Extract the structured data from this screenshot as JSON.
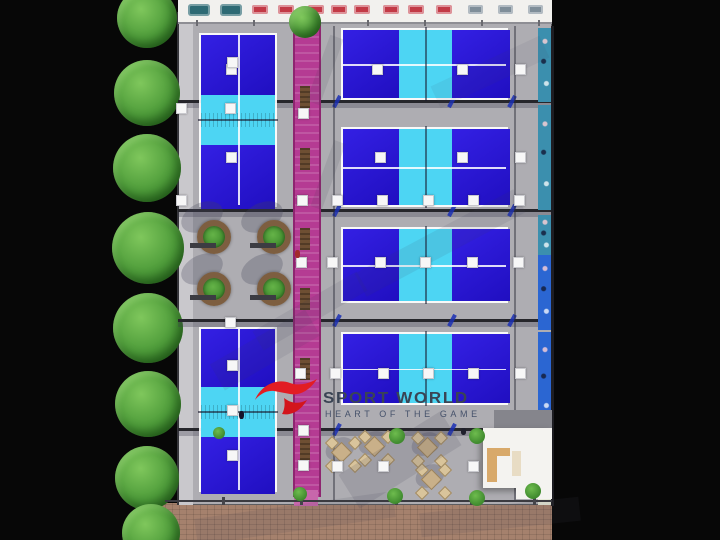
{
  "meta": {
    "description": "Top-down 3D architectural rendering of an indoor padel sports facility",
    "brand": {
      "title": "SPORT WORLD",
      "tagline": "HEART OF THE GAME"
    }
  },
  "colors": {
    "background": "#070707",
    "floor": "#aeadb2",
    "canopy": "#f2f1ee",
    "wall_left": "#c9c8cc",
    "court_blue": "#2712e2",
    "court_blue_dark": "#1d0abd",
    "court_cyan": "#4dd5f3",
    "court_line": "#ffffff",
    "walkway": "#b53b93",
    "walkway_edge": "#8e2570",
    "walkway_ramp": "#c767ab",
    "beam": "#26262b",
    "brace_blue": "#1b2fb4",
    "planter_ring": "#7d5e40",
    "bench_wood": "#6e4f33",
    "pavement": "#a5816d",
    "mural_teal": "#3b8fae",
    "mural_blue": "#2b66d2",
    "mural_pale": "#e6ead9",
    "building_white": "#f4f3f0",
    "roof_gray": "#85858c",
    "table_red": "#c23a46",
    "sofa_teal": "#2e6a74",
    "table_gray": "#7f8e99",
    "wood_counter": "#d8a96a",
    "light_white": "#f7f7f7",
    "logo_red": "#e21d23",
    "logo_text": "#3a4454"
  },
  "scene": {
    "building": {
      "x": 178,
      "y": 0,
      "w": 374,
      "h": 505
    },
    "pavement": {
      "x": 158,
      "y": 503,
      "w": 394,
      "h": 37
    },
    "canopy": {
      "x": 178,
      "y": 0,
      "w": 374,
      "h": 22
    },
    "left_wall": {
      "x": 177,
      "y": 12,
      "w": 14,
      "h": 493
    },
    "walkway": {
      "x": 293,
      "y": 20,
      "w": 24,
      "h": 477
    },
    "beams_y": [
      100,
      209,
      319,
      428
    ],
    "vertical_lines_x": [
      333,
      514
    ],
    "courts": [
      {
        "id": "court-left-top",
        "x": 199,
        "y": 33,
        "w": 78,
        "h": 174,
        "dir": "v",
        "bands": [
          60,
          50,
          64
        ]
      },
      {
        "id": "court-left-bottom",
        "x": 199,
        "y": 327,
        "w": 78,
        "h": 165,
        "dir": "v",
        "bands": [
          58,
          50,
          57
        ]
      },
      {
        "id": "court-right-1",
        "x": 341,
        "y": 28,
        "w": 167,
        "h": 72,
        "dir": "h",
        "bands": [
          56,
          53,
          58
        ]
      },
      {
        "id": "court-right-2",
        "x": 341,
        "y": 127,
        "w": 167,
        "h": 80,
        "dir": "h",
        "bands": [
          56,
          53,
          58
        ]
      },
      {
        "id": "court-right-3",
        "x": 341,
        "y": 227,
        "w": 167,
        "h": 76,
        "dir": "h",
        "bands": [
          56,
          53,
          58
        ]
      },
      {
        "id": "court-right-4",
        "x": 341,
        "y": 332,
        "w": 167,
        "h": 73,
        "dir": "h",
        "bands": [
          56,
          53,
          58
        ]
      }
    ],
    "trees_left": [
      {
        "cx": 147,
        "cy": 18,
        "r": 30
      },
      {
        "cx": 147,
        "cy": 93,
        "r": 33
      },
      {
        "cx": 147,
        "cy": 168,
        "r": 34
      },
      {
        "cx": 148,
        "cy": 248,
        "r": 36
      },
      {
        "cx": 148,
        "cy": 328,
        "r": 35
      },
      {
        "cx": 148,
        "cy": 404,
        "r": 33
      },
      {
        "cx": 147,
        "cy": 478,
        "r": 32
      },
      {
        "cx": 151,
        "cy": 533,
        "r": 29
      }
    ],
    "walkway_tree": {
      "cx": 305,
      "cy": 22,
      "r": 16
    },
    "bushes": [
      {
        "cx": 397,
        "cy": 436,
        "r": 8
      },
      {
        "cx": 477,
        "cy": 436,
        "r": 8
      },
      {
        "cx": 300,
        "cy": 494,
        "r": 7
      },
      {
        "cx": 395,
        "cy": 496,
        "r": 8
      },
      {
        "cx": 477,
        "cy": 498,
        "r": 8
      },
      {
        "cx": 533,
        "cy": 491,
        "r": 8
      },
      {
        "cx": 219,
        "cy": 433,
        "r": 6
      }
    ],
    "planters": [
      {
        "cx": 214,
        "cy": 237
      },
      {
        "cx": 274,
        "cy": 237
      },
      {
        "cx": 214,
        "cy": 289
      },
      {
        "cx": 274,
        "cy": 289
      }
    ],
    "walkway_benches_y": [
      86,
      148,
      228,
      288,
      358,
      438
    ],
    "lights": [
      [
        231,
        69
      ],
      [
        377,
        69
      ],
      [
        462,
        69
      ],
      [
        520,
        69
      ],
      [
        181,
        108
      ],
      [
        230,
        108
      ],
      [
        303,
        113
      ],
      [
        232,
        62
      ],
      [
        231,
        157
      ],
      [
        380,
        157
      ],
      [
        462,
        157
      ],
      [
        520,
        157
      ],
      [
        181,
        200
      ],
      [
        302,
        200
      ],
      [
        337,
        200
      ],
      [
        382,
        200
      ],
      [
        428,
        200
      ],
      [
        473,
        200
      ],
      [
        519,
        200
      ],
      [
        332,
        262
      ],
      [
        380,
        262
      ],
      [
        425,
        262
      ],
      [
        472,
        262
      ],
      [
        518,
        262
      ],
      [
        301,
        262
      ],
      [
        230,
        322
      ],
      [
        232,
        365
      ],
      [
        300,
        373
      ],
      [
        335,
        373
      ],
      [
        383,
        373
      ],
      [
        428,
        373
      ],
      [
        473,
        373
      ],
      [
        520,
        373
      ],
      [
        232,
        410
      ],
      [
        303,
        430
      ],
      [
        232,
        455
      ],
      [
        337,
        466
      ],
      [
        383,
        466
      ],
      [
        473,
        466
      ],
      [
        303,
        465
      ]
    ],
    "canopy_sofas_x": [
      188,
      220
    ],
    "canopy_tables_red_x": [
      252,
      278,
      308,
      331,
      354,
      383,
      408,
      436
    ],
    "canopy_tables_gray_x": [
      468,
      498,
      528
    ],
    "canopy_posts_x": [
      196,
      253,
      310,
      367,
      424,
      481,
      538
    ],
    "seating_clusters": [
      [
        341,
        452
      ],
      [
        374,
        446
      ],
      [
        427,
        447
      ],
      [
        431,
        479
      ]
    ],
    "mural_segments": [
      {
        "y": 28,
        "h": 74,
        "color_key": "mural_teal"
      },
      {
        "y": 105,
        "h": 105,
        "color_key": "mural_teal"
      },
      {
        "y": 215,
        "h": 40,
        "color_key": "mural_teal"
      },
      {
        "y": 255,
        "h": 75,
        "color_key": "mural_blue"
      },
      {
        "y": 332,
        "h": 98,
        "color_key": "mural_blue"
      },
      {
        "y": 430,
        "h": 75,
        "color_key": "mural_pale"
      }
    ],
    "white_building": {
      "roof": {
        "x": 494,
        "y": 410,
        "w": 58,
        "h": 22
      },
      "main": {
        "x": 483,
        "y": 428,
        "w": 69,
        "h": 60
      },
      "annex": {
        "x": 516,
        "y": 486,
        "w": 36,
        "h": 13
      },
      "counter_v": {
        "x": 487,
        "y": 448,
        "w": 10,
        "h": 34
      },
      "counter_h": {
        "x": 487,
        "y": 448,
        "w": 23,
        "h": 8
      },
      "shelf": {
        "x": 512,
        "y": 451,
        "w": 9,
        "h": 25
      }
    },
    "boundary_posts_x": [
      222,
      300,
      395,
      470,
      533
    ],
    "people": [
      {
        "x": 239,
        "y": 411,
        "w": 5,
        "h": 8,
        "c": "#15152a"
      },
      {
        "x": 295,
        "y": 250,
        "w": 5,
        "h": 8,
        "c": "#a22b2b"
      },
      {
        "x": 461,
        "y": 428,
        "w": 5,
        "h": 7,
        "c": "#20202c"
      }
    ],
    "shadow_streaks": [
      {
        "x": 318,
        "y": 35,
        "w": 14,
        "h": 70,
        "rot": 20,
        "op": 0.12
      },
      {
        "x": 322,
        "y": 140,
        "w": 12,
        "h": 70,
        "rot": 20,
        "op": 0.12
      },
      {
        "x": 350,
        "y": 230,
        "w": 180,
        "h": 26,
        "rot": -28,
        "op": 0.1
      },
      {
        "x": 210,
        "y": 335,
        "w": 110,
        "h": 30,
        "rot": -30,
        "op": 0.1
      },
      {
        "x": 340,
        "y": 440,
        "w": 120,
        "h": 40,
        "rot": -32,
        "op": 0.14
      },
      {
        "x": 195,
        "y": 505,
        "w": 200,
        "h": 26,
        "rot": -8,
        "op": 0.12
      },
      {
        "x": 430,
        "y": 60,
        "w": 120,
        "h": 24,
        "rot": -25,
        "op": 0.08
      },
      {
        "x": 250,
        "y": 300,
        "w": 120,
        "h": 22,
        "rot": -30,
        "op": 0.1
      },
      {
        "x": 420,
        "y": 505,
        "w": 160,
        "h": 24,
        "rot": -6,
        "op": 0.12
      }
    ]
  }
}
